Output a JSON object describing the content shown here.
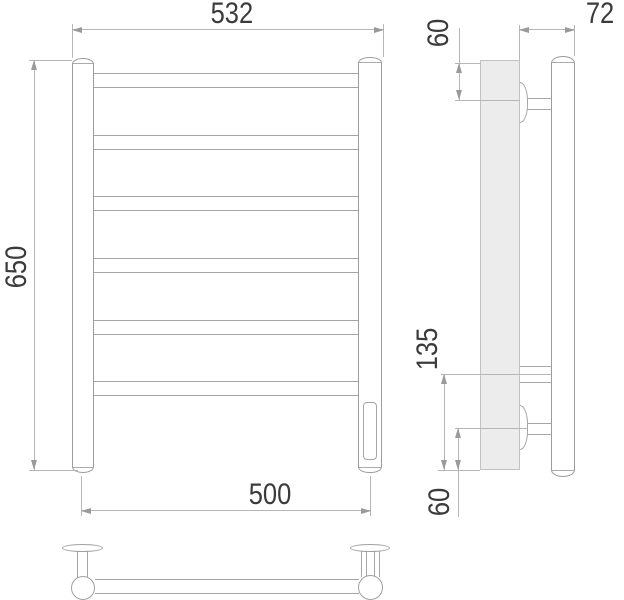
{
  "drawing_type": "towel-rail-technical-drawing",
  "dimensions": {
    "front_overall_width": "532",
    "front_overall_height": "650",
    "front_mounting_width": "500",
    "side_depth": "72",
    "side_top_bracket_offset": "60",
    "side_lower_span": "135",
    "side_bottom_bracket_offset": "60"
  },
  "colors": {
    "wall_fill": "#ececec",
    "object_line": "#9c9c9c",
    "dimension_line": "#b6b6b6",
    "text": "#3b3b3b"
  }
}
